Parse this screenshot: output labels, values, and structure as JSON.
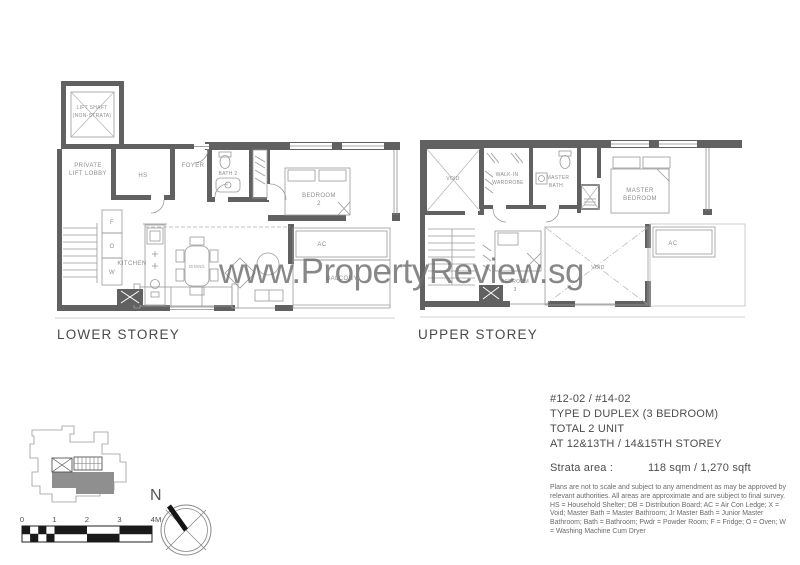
{
  "watermark": "www.PropertyReview.sg",
  "plans": {
    "lower": {
      "title": "LOWER STOREY",
      "rooms": {
        "lift_shaft_l1": "LIFT SHAFT",
        "lift_shaft_l2": "(NON-STRATA)",
        "lobby_l1": "PRIVATE",
        "lobby_l2": "LIFT LOBBY",
        "hs": "HS",
        "foyer": "FOYER",
        "bath2": "BATH 2",
        "bedroom2_l1": "BEDROOM",
        "bedroom2_l2": "2",
        "kitchen": "KITCHEN",
        "dining": "DINING",
        "fridge": "F",
        "oven": "O",
        "washer": "W",
        "ac": "AC",
        "balcony": "BALCONY"
      }
    },
    "upper": {
      "title": "UPPER STOREY",
      "rooms": {
        "void_top": "VOID",
        "walkin_l1": "WALK-IN",
        "walkin_l2": "WARDROBE",
        "master_bath_l1": "MASTER",
        "master_bath_l2": "BATH",
        "master_bed_l1": "MASTER",
        "master_bed_l2": "BEDROOM",
        "bedroom3_l1": "BEDROOM",
        "bedroom3_l2": "3",
        "void_main": "VOID",
        "ac": "AC"
      }
    }
  },
  "info": {
    "unit_numbers": "#12-02 / #14-02",
    "unit_type": "TYPE D DUPLEX (3 BEDROOM)",
    "total_units": "TOTAL 2 UNIT",
    "storey_range": "AT 12&13TH / 14&15TH STOREY",
    "strata_label": "Strata area :",
    "strata_value": "118 sqm / 1,270 sqft",
    "disclaimer": "Plans are not to scale and subject to any amendment as may be approved by relevant authorities. All areas are approximate and are subject to final survey.",
    "legend": "HS = Household Shelter; DB = Distribution Board; AC = Air Con Ledge; X = Void; Master Bath = Master Bathroom; Jr Master Bath = Junior Master Bathroom; Bath = Bathroom; Pwdr = Powder Room; F = Fridge; O = Oven; W = Washing Machine Cum Dryer"
  },
  "scale_bar": {
    "labels": [
      "0",
      "1",
      "2",
      "3",
      "4M"
    ]
  },
  "compass": {
    "north_label": "N"
  },
  "colors": {
    "wall": "#616161",
    "thin_line": "#9a9a9a",
    "label_text": "#8e8e8e",
    "watermark": "#6e6e6e",
    "site_unit_fill": "#8f8f8f"
  }
}
